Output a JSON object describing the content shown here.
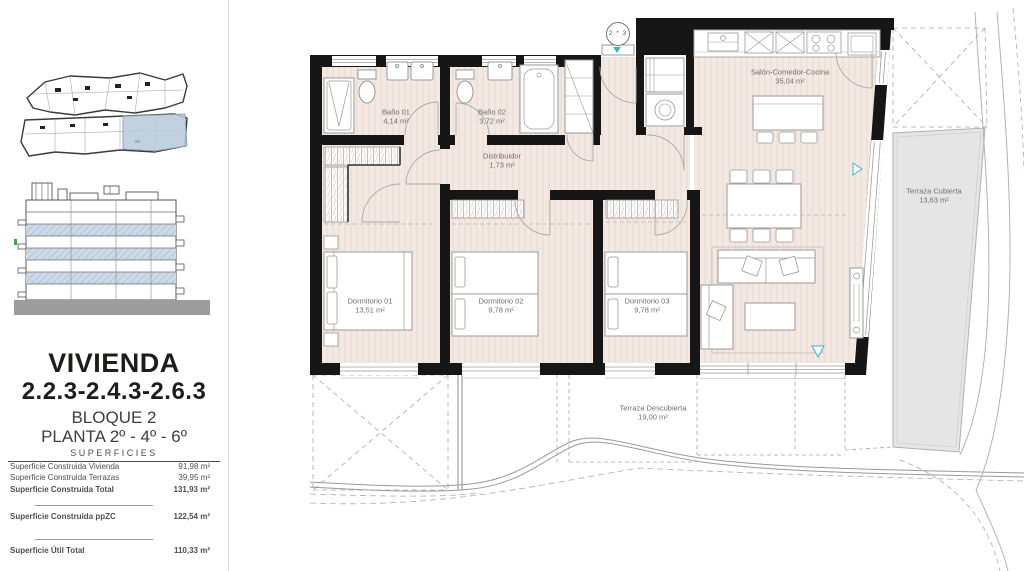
{
  "sidebar": {
    "title": "VIVIENDA",
    "subtitle": "2.2.3-2.4.3-2.6.3",
    "block": "BLOQUE 2",
    "floor": "PLANTA 2º - 4º - 6º",
    "table_header": "SUPERFICIES",
    "rows": [
      {
        "label": "Superficie Construida Vivienda",
        "value": "91,98 m²"
      },
      {
        "label": "Superficie Construida Terrazas",
        "value": "39,95 m²"
      },
      {
        "label": "Superficie Construida Total",
        "value": "131,93 m²"
      },
      {
        "label": "Superficie Construida ppZC",
        "value": "122,54 m²"
      },
      {
        "label": "Superficie Útil Total",
        "value": "110,33 m²"
      }
    ]
  },
  "plan": {
    "entry_marker": "2 * 3",
    "rooms": [
      {
        "name": "Baño 01",
        "area": "4,14 m²"
      },
      {
        "name": "Baño 02",
        "area": "3,72 m²"
      },
      {
        "name": "Distribuidor",
        "area": "1,73 m²"
      },
      {
        "name": "Salón-Comedor-Cocina",
        "area": "35,04 m²"
      },
      {
        "name": "Dormitorio 01",
        "area": "13,51 m²"
      },
      {
        "name": "Dormitorio 02",
        "area": "9,78 m²"
      },
      {
        "name": "Dormitorio 03",
        "area": "9,78 m²"
      },
      {
        "name": "Terraza Cubierta",
        "area": "13,63 m²"
      },
      {
        "name": "Terraza Descubierta",
        "area": "19,00 m²"
      }
    ]
  },
  "colors": {
    "wall": "#161616",
    "floor": "#f3e8e2",
    "terrace_gray": "#e5e5e5",
    "accent_teal": "#35b6c9",
    "highlight_blue": "#b7c9da"
  }
}
